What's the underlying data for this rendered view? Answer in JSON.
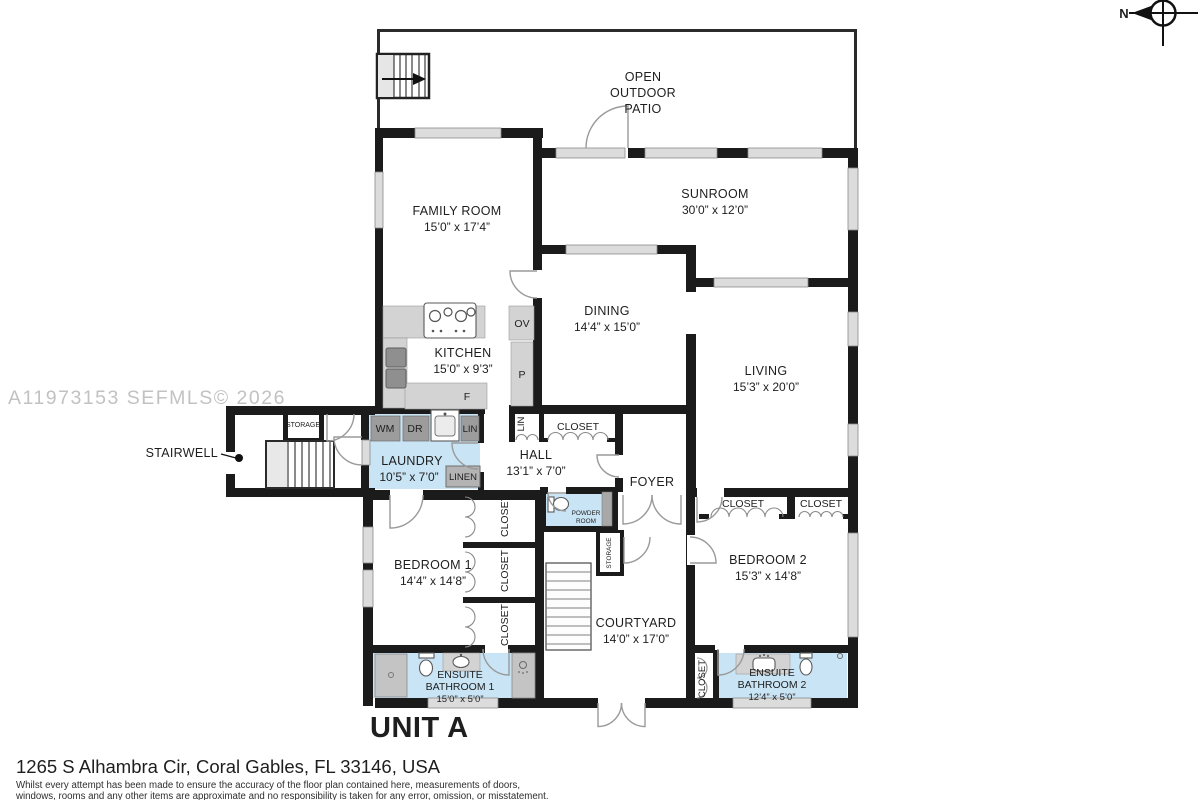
{
  "watermark": "A11973153  SEFMLS© 2026",
  "compass": {
    "north_label": "N"
  },
  "unit": {
    "label": "UNIT A"
  },
  "address": "1265 S Alhambra Cir, Coral Gables, FL 33146, USA",
  "disclaimer": {
    "line1": "Whilst every attempt has been made to ensure the accuracy of the floor plan contained here, measurements of doors,",
    "line2": "windows, rooms and any other items are approximate and no responsibility is taken for any error, omission, or misstatement."
  },
  "rooms": {
    "patio": {
      "line1": "OPEN",
      "line2": "OUTDOOR",
      "line3": "PATIO"
    },
    "family": {
      "name": "FAMILY ROOM",
      "dims": "15’0” x 17’4”"
    },
    "sunroom": {
      "name": "SUNROOM",
      "dims": "30’0” x 12’0”"
    },
    "dining": {
      "name": "DINING",
      "dims": "14’4” x 15’0”"
    },
    "living": {
      "name": "LIVING",
      "dims": "15’3” x 20’0”"
    },
    "kitchen": {
      "name": "KITCHEN",
      "dims": "15’0” x 9’3”"
    },
    "laundry": {
      "name": "LAUNDRY",
      "dims": "10’5” x 7’0”"
    },
    "hall": {
      "name": "HALL",
      "dims": "13’1” x 7’0”"
    },
    "foyer": {
      "name": "FOYER"
    },
    "stairwell": {
      "name": "STAIRWELL"
    },
    "bedroom1": {
      "name": "BEDROOM 1",
      "dims": "14’4” x 14’8”"
    },
    "bedroom2": {
      "name": "BEDROOM 2",
      "dims": "15’3” x 14’8”"
    },
    "courtyard": {
      "name": "COURTYARD",
      "dims": "14’0” x 17’0”"
    },
    "ensuite1": {
      "line1": "ENSUITE",
      "line2": "BATHROOM 1",
      "dims": "15’0” x 5’0”"
    },
    "ensuite2": {
      "line1": "ENSUITE",
      "line2": "BATHROOM 2",
      "dims": "12’4” x 5’0”"
    },
    "powder": {
      "line1": "POWDER",
      "line2": "ROOM"
    }
  },
  "labels": {
    "closet": "CLOSET",
    "storage": "STORAGE",
    "linen": "LINEN",
    "lin": "LIN",
    "wm": "WM",
    "dr": "DR",
    "ov": "OV",
    "p": "P",
    "f": "F"
  },
  "colors": {
    "wall": "#1b1b1b",
    "wet_room_blue": "#c9e4f4",
    "fixture_gray": "#d3d3d3",
    "appliance_gray": "#9c9c9c",
    "window_gray": "#dcdcdc",
    "watermark_gray": "#c2c2c2"
  }
}
